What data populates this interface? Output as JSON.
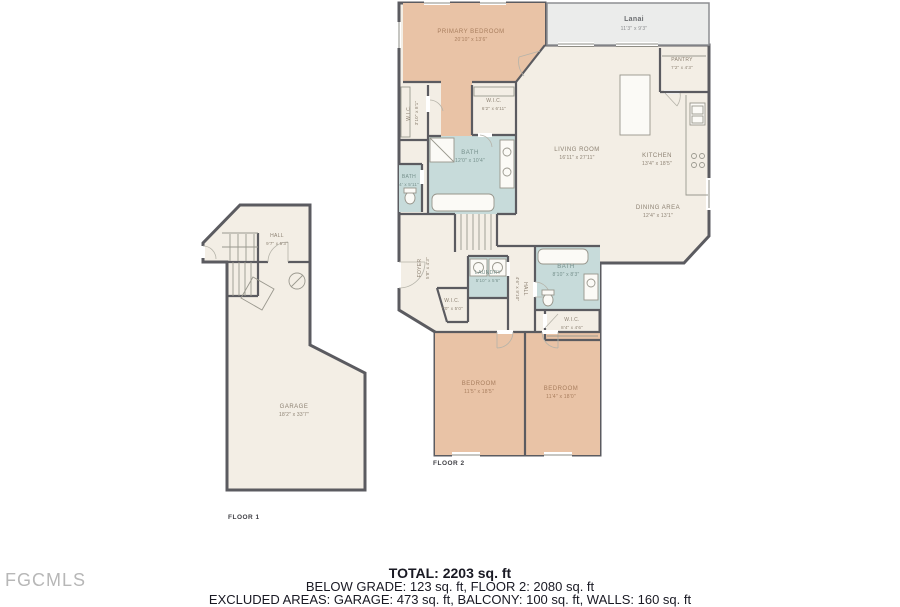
{
  "watermark": "FGCMLS",
  "floors": {
    "floor1": "FLOOR 1",
    "floor2": "FLOOR 2"
  },
  "summary": {
    "total": "TOTAL: 2203 sq. ft",
    "included": "BELOW GRADE: 123 sq. ft, FLOOR 2: 2080 sq. ft",
    "excluded": "EXCLUDED AREAS: GARAGE: 473 sq. ft, BALCONY: 100 sq. ft, WALLS: 160 sq. ft"
  },
  "rooms": {
    "primary_bedroom": {
      "name": "PRIMARY BEDROOM",
      "dims": "20'10\" x 13'6\""
    },
    "lanai": {
      "name": "Lanai",
      "dims": "11'3\" x 9'3\""
    },
    "pantry": {
      "name": "PANTRY",
      "dims": "7'2\" x 4'3\""
    },
    "living_room": {
      "name": "LIVING ROOM",
      "dims": "16'11\" x 27'11\""
    },
    "kitchen": {
      "name": "KITCHEN",
      "dims": "13'4\" x 18'5\""
    },
    "dining_area": {
      "name": "DINING AREA",
      "dims": "12'4\" x 13'1\""
    },
    "wic_primary": {
      "name": "W.I.C.",
      "dims": "6'2\" x 6'11\""
    },
    "wic_left": {
      "name": "W.I.C.",
      "dims": "3'10\" x 8'1\""
    },
    "bath_primary": {
      "name": "BATH",
      "dims": "12'0\" x 10'4\""
    },
    "bath_small": {
      "name": "BATH",
      "dims": "4' x 5'11\""
    },
    "foyer": {
      "name": "FOYER",
      "dims": "5'8\" x 4'3\""
    },
    "laundry": {
      "name": "LAUNDRY",
      "dims": "5'10\" x 5'6\""
    },
    "wic_hall": {
      "name": "W.I.C.",
      "dims": "7'0\" x 5'0\""
    },
    "hall_upper": {
      "name": "HALL",
      "dims": "4'6\" x 9'10\""
    },
    "bath_2": {
      "name": "BATH",
      "dims": "8'10\" x 8'3\""
    },
    "wic_2": {
      "name": "W.I.C.",
      "dims": "8'4\" x 4'6\""
    },
    "bedroom_1": {
      "name": "BEDROOM",
      "dims": "11'5\" x 18'5\""
    },
    "bedroom_2": {
      "name": "BEDROOM",
      "dims": "11'4\" x 18'0\""
    },
    "hall_floor1": {
      "name": "HALL",
      "dims": "9'7\" x 5'3\""
    },
    "garage": {
      "name": "GARAGE",
      "dims": "18'2\" x 33'7\""
    }
  },
  "colors": {
    "bedroom_fill": "#e9c3a6",
    "bath_fill": "#c7dbda",
    "floor_fill": "#f3eee5",
    "lanai_fill": "#ebeceb",
    "wall": "#5b5b60",
    "room_label": "#8c8172",
    "bedroom_label": "#a87e5e",
    "bath_label": "#76908c",
    "summary_text": "#191923",
    "watermark_text": "#b7b7b7"
  }
}
